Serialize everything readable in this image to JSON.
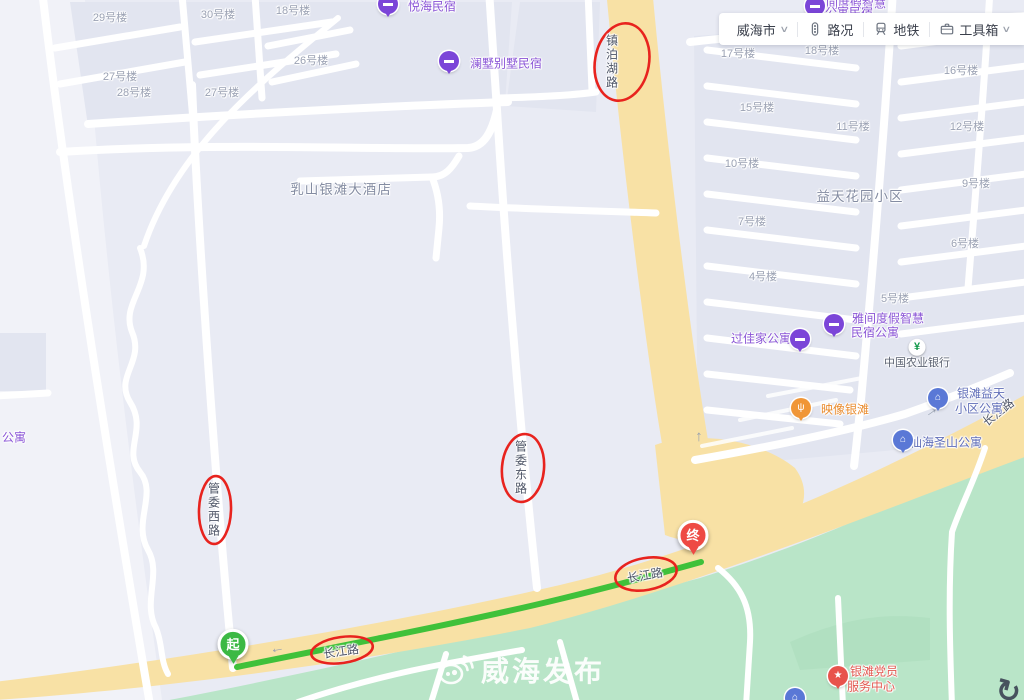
{
  "toolbar": {
    "city": {
      "label": "威海市",
      "caret": "∨"
    },
    "traffic": {
      "label": "路况"
    },
    "metro": {
      "label": "地铁"
    },
    "toolbox": {
      "label": "工具箱",
      "caret": "∨"
    }
  },
  "watermark": {
    "text": "威海发布"
  },
  "annotation_color": "#e8231e",
  "route": {
    "color": "#3fc13a",
    "markers": [
      {
        "text": "起",
        "x": 233,
        "y": 649,
        "color": "#3cb944"
      },
      {
        "text": "终",
        "x": 693,
        "y": 540,
        "color": "#ee4a44"
      }
    ]
  },
  "annotations": [
    {
      "text": "镇泊湖路",
      "x": 612,
      "y": 62,
      "vertical": true
    },
    {
      "text": "管委东路",
      "x": 521,
      "y": 468,
      "vertical": true
    },
    {
      "text": "管委西路",
      "x": 214,
      "y": 510,
      "vertical": true
    },
    {
      "text": "长江路",
      "x": 645,
      "y": 575,
      "rot": -10
    },
    {
      "text": "长江路",
      "x": 341,
      "y": 651,
      "rot": -8
    }
  ],
  "road_labels": [
    {
      "text": "长江路",
      "x": 998,
      "y": 412,
      "rot": -38
    }
  ],
  "area_labels": [
    {
      "text": "益天花园小区",
      "x": 860,
      "y": 195
    },
    {
      "text": "乳山银滩大酒店",
      "x": 341,
      "y": 188
    }
  ],
  "building_labels": [
    {
      "text": "29号楼",
      "x": 110,
      "y": 17
    },
    {
      "text": "30号楼",
      "x": 218,
      "y": 14
    },
    {
      "text": "18号楼",
      "x": 293,
      "y": 10
    },
    {
      "text": "26号楼",
      "x": 311,
      "y": 60
    },
    {
      "text": "27号楼",
      "x": 120,
      "y": 76
    },
    {
      "text": "28号楼",
      "x": 134,
      "y": 92
    },
    {
      "text": "27号楼",
      "x": 222,
      "y": 92
    },
    {
      "text": "17号楼",
      "x": 738,
      "y": 53
    },
    {
      "text": "18号楼",
      "x": 822,
      "y": 50
    },
    {
      "text": "16号楼",
      "x": 961,
      "y": 70
    },
    {
      "text": "15号楼",
      "x": 757,
      "y": 107
    },
    {
      "text": "11号楼",
      "x": 853,
      "y": 126
    },
    {
      "text": "12号楼",
      "x": 967,
      "y": 126
    },
    {
      "text": "10号楼",
      "x": 742,
      "y": 163
    },
    {
      "text": "9号楼",
      "x": 976,
      "y": 183
    },
    {
      "text": "7号楼",
      "x": 752,
      "y": 221
    },
    {
      "text": "6号楼",
      "x": 965,
      "y": 243
    },
    {
      "text": "4号楼",
      "x": 763,
      "y": 276
    },
    {
      "text": "5号楼",
      "x": 895,
      "y": 298
    }
  ],
  "poi_labels": [
    {
      "text": "悦海民宿",
      "x": 432,
      "y": 6,
      "cls": "purple"
    },
    {
      "text": "澜墅别墅民宿",
      "x": 506,
      "y": 63,
      "cls": "purple"
    },
    {
      "text": "间度假智慧",
      "x": 856,
      "y": 3,
      "cls": "purple"
    },
    {
      "text": "公寓民宿",
      "x": 849,
      "y": 12,
      "cls": "purple"
    },
    {
      "text": "过佳家公寓",
      "x": 761,
      "y": 338,
      "cls": "purple"
    },
    {
      "text": "雅间度假智慧",
      "x": 888,
      "y": 318,
      "cls": "purple"
    },
    {
      "text": "民宿公寓",
      "x": 875,
      "y": 332,
      "cls": "purple"
    },
    {
      "text": "映像银滩",
      "x": 845,
      "y": 409,
      "cls": "orange"
    },
    {
      "text": "银滩益天",
      "x": 981,
      "y": 393,
      "cls": "blue"
    },
    {
      "text": "小区公寓",
      "x": 979,
      "y": 408,
      "cls": "blue"
    },
    {
      "text": "仙海圣山公寓",
      "x": 946,
      "y": 442,
      "cls": "blue"
    },
    {
      "text": "中国农业银行",
      "x": 917,
      "y": 362,
      "cls": "dark-sm"
    },
    {
      "text": "银滩党员",
      "x": 874,
      "y": 671,
      "cls": "red"
    },
    {
      "text": "服务中心",
      "x": 871,
      "y": 686,
      "cls": "red"
    },
    {
      "text": "公寓",
      "x": 14,
      "y": 437,
      "cls": "purple"
    }
  ],
  "pins": [
    {
      "icon": "bed-icon",
      "char": "▬",
      "x": 388,
      "y": 6,
      "color": "#7b45d8"
    },
    {
      "icon": "bed-icon",
      "char": "▬",
      "x": 449,
      "y": 63,
      "color": "#7b45d8"
    },
    {
      "icon": "bed-icon",
      "char": "▬",
      "x": 815,
      "y": 8,
      "color": "#7b45d8"
    },
    {
      "icon": "bed-icon",
      "char": "▬",
      "x": 800,
      "y": 341,
      "color": "#7b45d8"
    },
    {
      "icon": "bed-icon",
      "char": "▬",
      "x": 834,
      "y": 326,
      "color": "#7b45d8"
    },
    {
      "icon": "restaurant-icon",
      "char": "ψ",
      "x": 801,
      "y": 410,
      "color": "#f09637"
    },
    {
      "icon": "building-icon",
      "char": "⌂",
      "x": 938,
      "y": 400,
      "color": "#5a78d6"
    },
    {
      "icon": "building-icon",
      "char": "⌂",
      "x": 903,
      "y": 442,
      "color": "#5a78d6"
    },
    {
      "icon": "star-icon",
      "char": "★",
      "x": 838,
      "y": 678,
      "color": "#e8534c"
    },
    {
      "icon": "bank-icon",
      "char": "¥",
      "x": 917,
      "y": 349,
      "cls": "pin-bank"
    },
    {
      "icon": "building-icon",
      "char": "⌂",
      "x": 795,
      "y": 694,
      "color": "#5a78d6",
      "cls": "pin-clipped"
    }
  ],
  "arrows": [
    {
      "char": "←",
      "x": 277,
      "y": 648,
      "rot": -10
    },
    {
      "char": "←",
      "x": 701,
      "y": 437,
      "rot": 90
    },
    {
      "char": "←",
      "x": 933,
      "y": 414,
      "rot": 145
    }
  ],
  "decor_icons": [
    {
      "char": "↻",
      "x": 1008,
      "y": 692,
      "rot": 15
    }
  ]
}
